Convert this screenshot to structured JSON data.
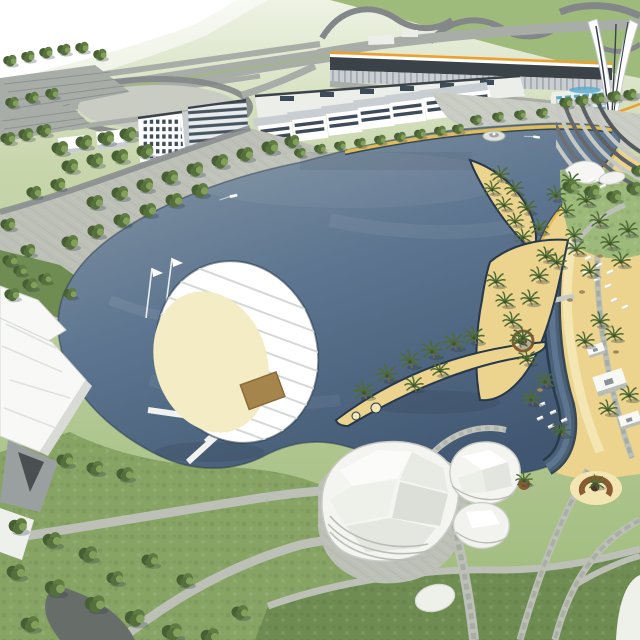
{
  "scene": {
    "title": "Aerial rendering of a lagoon waterfront leisure development",
    "type": "3d-architectural-visualization",
    "landmarks": [
      "highway interchange and racetrack curves",
      "parking lots with tree rows",
      "oval event lot with ring road",
      "long grandstand building with orange fascia stripe",
      "flaring white observation tower",
      "retail village of white low-rise buildings",
      "hotel block with window grid",
      "blue glass pavilion with roof pools",
      "large grey-blue lagoon with two boats and fountain island",
      "tree-lined promenade with lawns",
      "white folded-plate shade canopies",
      "circular sail-canopy marina island with timber deck",
      "white chevron piers in the water",
      "sandy beach with palm trees, loungers and pavilions",
      "crescent-shaped sand islands",
      "amphitheatre steps at the north-east water corner",
      "faceted white dome pavilions",
      "sand plaza with circular planter feature",
      "lawns crossed by paved paths"
    ]
  },
  "colors": {
    "white": "#ffffff",
    "field": "#c9d6ad",
    "field_top": "#eef3e4",
    "grass_bright": "#9dba7a",
    "grass": "#87a465",
    "grass_dark": "#6f8d52",
    "track_green": "#9fbb7c",
    "road": "#a9ada7",
    "road_dark": "#83878a",
    "asphalt": "#6d7173",
    "pavement": "#bcc0b6",
    "pavement_light": "#c9ccc3",
    "pavement_dark": "#9aa095",
    "plaza_dark": "#676d68",
    "water_top": "#8496a4",
    "water_mid": "#5d7590",
    "water_deep": "#415771",
    "water_edge": "#26384a",
    "sand": "#ecd48e",
    "sand_light": "#f4e6b2",
    "sand_gold": "#e2bd55",
    "cream": "#f4ecc4",
    "canopy": "#f8f9f6",
    "canopy_shade": "#d9dcd6",
    "facade": "#eceeea",
    "facade_shade": "#c9ced2",
    "roof_dark": "#3b4248",
    "window_dark": "#3e4b58",
    "glass_blue": "#57a9cd",
    "accent_orange": "#efa02c",
    "tree": "#5f7c43",
    "tree_mid": "#55703c",
    "tree_dark": "#465f33",
    "tree_light": "#83a05a",
    "palm": "#4f6b35",
    "palm_dark": "#3c5428",
    "trunk": "#7d6647",
    "deck_brown": "#a5854c",
    "planter_brown": "#8a5c33",
    "shadow": "#2b3a48"
  }
}
